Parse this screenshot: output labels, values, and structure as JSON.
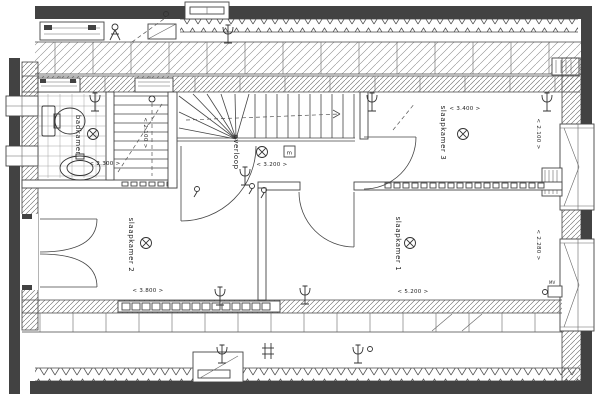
{
  "rooms": {
    "badkamer": {
      "label": "badkamer",
      "dim_width": "< 2.300 >"
    },
    "overloop": {
      "label": "overloop",
      "dim_width": "< 3.200 >"
    },
    "slaapkamer2": {
      "label": "slaapkamer 2",
      "dim_width": "< 3.800 >"
    },
    "slaapkamer1": {
      "label": "slaapkamer 1",
      "dim_width": "< 5.200 >",
      "dim_depth": "< 2.280 >"
    },
    "slaapkamer3": {
      "label": "slaapkamer 3",
      "dim_width": "< 3.400 >",
      "dim_depth": "< 2.100 >"
    }
  },
  "stairs": {
    "dim_depth": "< 2.100 >"
  },
  "annotations": {
    "meter_cupboard": "m",
    "mechanical_vent": "MV"
  },
  "colors": {
    "wall": "#424242",
    "line": "#444444",
    "hatch": "#666666",
    "background": "#ffffff",
    "text": "#222222"
  }
}
